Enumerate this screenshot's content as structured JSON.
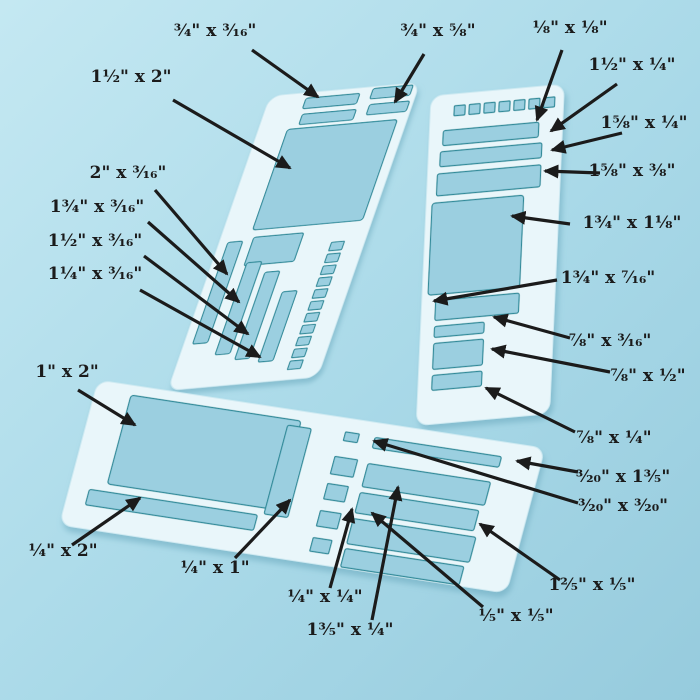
{
  "colors": {
    "background_light": "#c4e8f2",
    "background": "#a3d5e5",
    "sheet": "#e9f6fa",
    "sheet_edge": "#cfeaf2",
    "cutout": "#9bcfe0",
    "cutout_edge": "#2d8a99",
    "ink": "#1b1b1b"
  },
  "annotations": [
    {
      "text": "³⁄₄\" x ³⁄₁₆\""
    },
    {
      "text": "³⁄₄\" x ⁵⁄₈\""
    },
    {
      "text": "¹⁄₈\" x ¹⁄₈\""
    },
    {
      "text": "1¹⁄₂\" x 2\""
    },
    {
      "text": "1¹⁄₂\" x ¹⁄₄\""
    },
    {
      "text": "1⁵⁄₈\" x ¹⁄₄\""
    },
    {
      "text": "1⁵⁄₈\" x ³⁄₈\""
    },
    {
      "text": "1³⁄₄\" x 1¹⁄₈\""
    },
    {
      "text": "2\" x ³⁄₁₆\""
    },
    {
      "text": "1³⁄₄\" x ³⁄₁₆\""
    },
    {
      "text": "1¹⁄₂\" x ³⁄₁₆\""
    },
    {
      "text": "1¹⁄₄\" x ³⁄₁₆\""
    },
    {
      "text": "1³⁄₄\" x ⁷⁄₁₆\""
    },
    {
      "text": "⁷⁄₈\" x ³⁄₁₆\""
    },
    {
      "text": "⁷⁄₈\" x ¹⁄₂\""
    },
    {
      "text": "⁷⁄₈\" x ¹⁄₄\""
    },
    {
      "text": "³⁄₂₀\" x 1³⁄₅\""
    },
    {
      "text": "³⁄₂₀\" x ³⁄₂₀\""
    },
    {
      "text": "1\" x 2\""
    },
    {
      "text": "¹⁄₄\" x 2\""
    },
    {
      "text": "¹⁄₄\" x 1\""
    },
    {
      "text": "¹⁄₄\" x ¹⁄₄\""
    },
    {
      "text": "1³⁄₅\" x ¹⁄₄\""
    },
    {
      "text": "¹⁄₅\" x ¹⁄₅\""
    },
    {
      "text": "1²⁄₅\" x ¹⁄₅\""
    }
  ]
}
